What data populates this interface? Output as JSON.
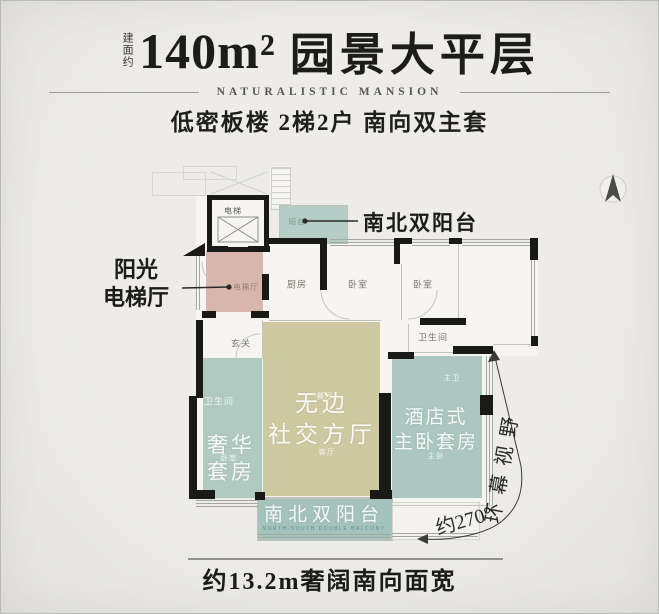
{
  "header": {
    "area_label": "建面约",
    "area_value": "140m²",
    "title": "园景大平层",
    "subtitle": "NATURALISTIC MANSION",
    "tagline": "低密板楼 2梯2户 南向双主套"
  },
  "plan": {
    "rooms": [
      {
        "id": "elevator",
        "label": "电梯"
      },
      {
        "id": "balcony-top",
        "label": "阳台"
      },
      {
        "id": "kitchen",
        "label": "厨房"
      },
      {
        "id": "bedroom-1",
        "label": "卧室"
      },
      {
        "id": "bedroom-2",
        "label": "卧室"
      },
      {
        "id": "foyer",
        "label": "玄关"
      },
      {
        "id": "bathroom-1",
        "label": "卫生间"
      },
      {
        "id": "bathroom-2",
        "label": "卫生间"
      },
      {
        "id": "master-bath",
        "label": "主卫"
      },
      {
        "id": "dining",
        "label": "餐厅"
      },
      {
        "id": "living",
        "label": "客厅"
      },
      {
        "id": "suite-bedroom",
        "label": "卧室"
      },
      {
        "id": "master-bedroom",
        "label": "主卧"
      },
      {
        "id": "elevator-hall",
        "label": "电梯厅"
      }
    ],
    "zones": {
      "living": {
        "line1": "无边",
        "line2": "社交方厅"
      },
      "left_suite": {
        "line1": "奢华",
        "line2": "套房"
      },
      "master_suite": {
        "line1": "酒店式",
        "line2": "主卧套房"
      },
      "balcony_bottom": {
        "label": "南北双阳台",
        "caption": "NORTH-SOUTH DOUBLE BALCONY"
      }
    },
    "callouts": {
      "balcony_top": "南北双阳台",
      "elevator_hall": {
        "line1": "阳光",
        "line2": "电梯厅"
      }
    },
    "view": {
      "angle": "约270°",
      "text": "环幕视野"
    },
    "dimension": {
      "label": "约13.2m奢阔南向面宽"
    }
  },
  "colors": {
    "teal": "#aec8c1",
    "olive": "#cfc9a1",
    "pink": "#d8b6ab",
    "wall": "#191917",
    "background": "#e9e8e4",
    "ink": "#1c1c1a"
  }
}
